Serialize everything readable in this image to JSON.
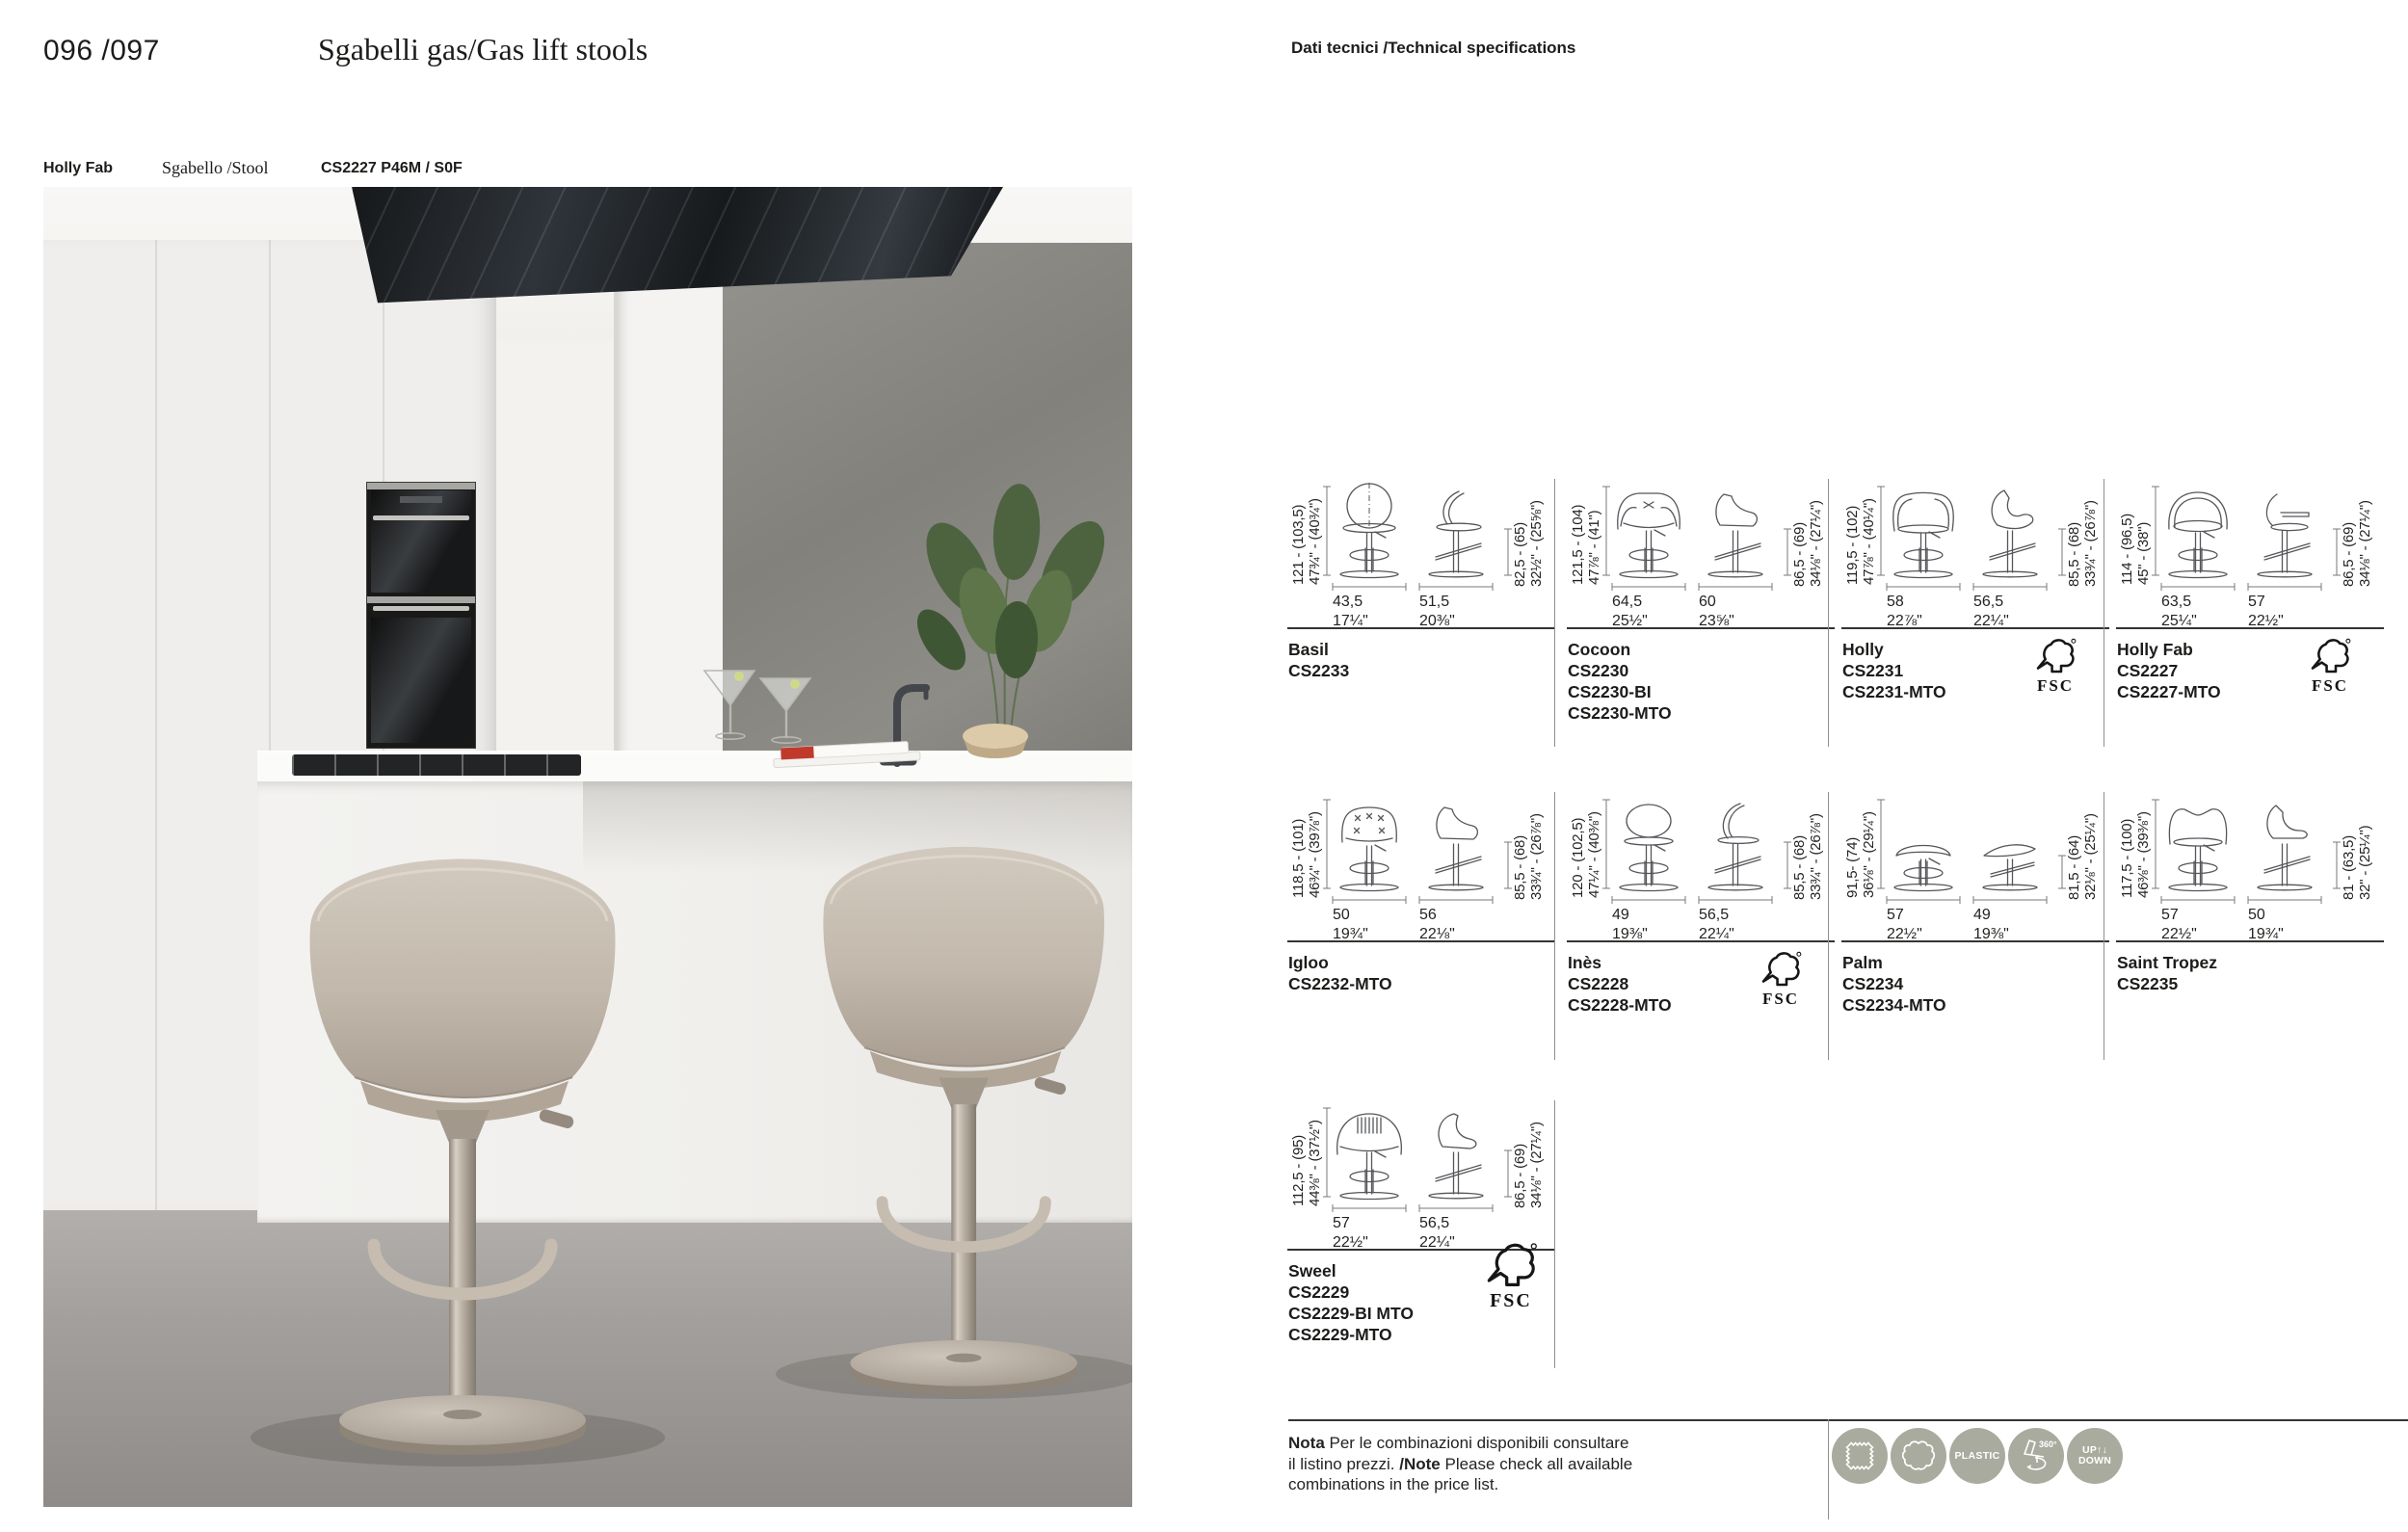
{
  "header": {
    "page_numbers": "096 /097",
    "title": "Sgabelli gas/Gas lift stools",
    "tech_label": "Dati tecnici /Technical specifications"
  },
  "photo_caption": {
    "model": "Holly Fab",
    "type": "Sgabello /Stool",
    "code": "CS2227 P46M / S0F"
  },
  "spec_cells": [
    {
      "name": "Basil",
      "codes": [
        "CS2233"
      ],
      "fsc": false,
      "variant": "basil",
      "col": 0,
      "row": 0,
      "h_cm": "121 - (103,5)",
      "h_in": "47¾\" - (40¾\")",
      "w1_cm": "43,5",
      "w1_in": "17¼\"",
      "w2_cm": "51,5",
      "w2_in": "20⅜\"",
      "s_cm": "82,5 - (65)",
      "s_in": "32½\" - (25⅝\")"
    },
    {
      "name": "Cocoon",
      "codes": [
        "CS2230",
        "CS2230-BI",
        "CS2230-MTO"
      ],
      "fsc": false,
      "variant": "cocoon",
      "col": 1,
      "row": 0,
      "h_cm": "121,5 - (104)",
      "h_in": "47⅞\" - (41\")",
      "w1_cm": "64,5",
      "w1_in": "25½\"",
      "w2_cm": "60",
      "w2_in": "23⅝\"",
      "s_cm": "86,5 - (69)",
      "s_in": "34⅛\" - (27¼\")"
    },
    {
      "name": "Holly",
      "codes": [
        "CS2231",
        "CS2231-MTO"
      ],
      "fsc": true,
      "variant": "holly",
      "col": 2,
      "row": 0,
      "h_cm": "119,5 - (102)",
      "h_in": "47⅞\" - (40¼\")",
      "w1_cm": "58",
      "w1_in": "22⅞\"",
      "w2_cm": "56,5",
      "w2_in": "22¼\"",
      "s_cm": "85,5 - (68)",
      "s_in": "33¾\" - (26⅞\")"
    },
    {
      "name": "Holly Fab",
      "codes": [
        "CS2227",
        "CS2227-MTO"
      ],
      "fsc": true,
      "variant": "hollyfab",
      "col": 3,
      "row": 0,
      "h_cm": "114 - (96,5)",
      "h_in": "45\" - (38\")",
      "w1_cm": "63,5",
      "w1_in": "25¼\"",
      "w2_cm": "57",
      "w2_in": "22½\"",
      "s_cm": "86,5 - (69)",
      "s_in": "34⅛\" - (27¼\")"
    },
    {
      "name": "Igloo",
      "codes": [
        "CS2232-MTO"
      ],
      "fsc": false,
      "variant": "igloo",
      "col": 0,
      "row": 1,
      "h_cm": "118,5 - (101)",
      "h_in": "46¾\" - (39⅞\")",
      "w1_cm": "50",
      "w1_in": "19¾\"",
      "w2_cm": "56",
      "w2_in": "22⅛\"",
      "s_cm": "85,5 - (68)",
      "s_in": "33¾\" - (26⅞\")"
    },
    {
      "name": "Inès",
      "codes": [
        "CS2228",
        "CS2228-MTO"
      ],
      "fsc": true,
      "variant": "ines",
      "col": 1,
      "row": 1,
      "h_cm": "120 - (102,5)",
      "h_in": "47¼\" - (40⅜\")",
      "w1_cm": "49",
      "w1_in": "19⅜\"",
      "w2_cm": "56,5",
      "w2_in": "22¼\"",
      "s_cm": "85,5 - (68)",
      "s_in": "33¾\" - (26⅞\")"
    },
    {
      "name": "Palm",
      "codes": [
        "CS2234",
        "CS2234-MTO"
      ],
      "fsc": false,
      "variant": "palm",
      "col": 2,
      "row": 1,
      "h_cm": "91,5- (74)",
      "h_in": "36⅛\" - (29¼\")",
      "w1_cm": "57",
      "w1_in": "22½\"",
      "w2_cm": "49",
      "w2_in": "19⅜\"",
      "s_cm": "81,5 - (64)",
      "s_in": "32⅛\" - (25¼\")"
    },
    {
      "name": "Saint Tropez",
      "codes": [
        "CS2235"
      ],
      "fsc": false,
      "variant": "sainttropez",
      "col": 3,
      "row": 1,
      "h_cm": "117,5 - (100)",
      "h_in": "46⅜\" - (39⅜\")",
      "w1_cm": "57",
      "w1_in": "22½\"",
      "w2_cm": "50",
      "w2_in": "19¾\"",
      "s_cm": "81 - (63,5)",
      "s_in": "32\" - (25¼\")"
    },
    {
      "name": "Sweel",
      "codes": [
        "CS2229",
        "CS2229-BI MTO",
        "CS2229-MTO"
      ],
      "fsc": true,
      "fsc_large": true,
      "variant": "sweel",
      "col": 0,
      "row": 2,
      "h_cm": "112,5 - (95)",
      "h_in": "44⅜\" - (37½\")",
      "w1_cm": "57",
      "w1_in": "22½\"",
      "w2_cm": "56,5",
      "w2_in": "22¼\"",
      "s_cm": "86,5 - (69)",
      "s_in": "34⅛\" - (27¼\")"
    }
  ],
  "fsc_label": "FSC",
  "note": {
    "lines": [
      [
        {
          "b": "Nota"
        },
        {
          "t": " Per le combinazioni disponibili consultare"
        }
      ],
      [
        {
          "t": "il listino prezzi. "
        },
        {
          "b": "/Note"
        },
        {
          "t": " Please check all available"
        }
      ],
      [
        {
          "t": "combinations in the price list."
        }
      ]
    ]
  },
  "badges": [
    {
      "icon": "fabric-swatch-icon"
    },
    {
      "icon": "leather-icon"
    },
    {
      "icon": "plastic-icon",
      "label": "PLASTIC"
    },
    {
      "icon": "swivel-360-icon",
      "label": "360°"
    },
    {
      "icon": "up-down-icon",
      "lines": [
        "UP↑↓",
        "DOWN"
      ]
    }
  ],
  "colors": {
    "badge": "#a9ab9e",
    "ink": "#1c1c1a",
    "rule": "#343432",
    "divider": "#8f8f8d",
    "diagram_line": "#55565a"
  }
}
